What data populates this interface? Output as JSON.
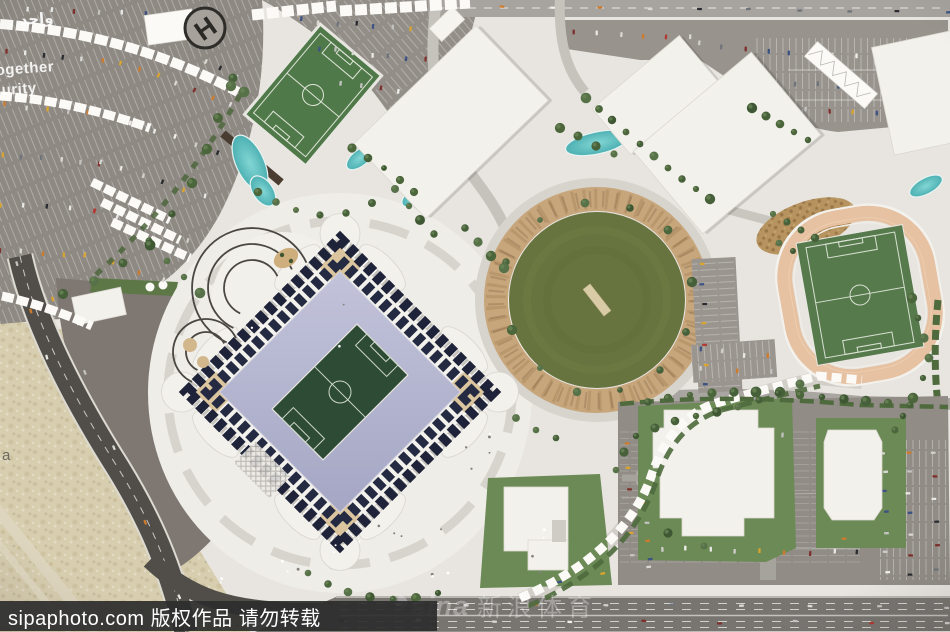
{
  "photo": {
    "subject": "Aerial photograph of an architectural scale model of a stadium sports precinct with training pitch, cricket oval, athletics track, parking fields and desert highway",
    "helipad_letter": "H",
    "ground_text": {
      "arabic_word": "واحد",
      "english_fragment_1": "ogether",
      "english_fragment_2": "urity",
      "sand_letter": "a"
    }
  },
  "watermarks": {
    "sipa_text": "sipaphoto.com 版权作品 请勿转载",
    "sina_brand": "sina",
    "sina_suffix": "新浪体育"
  },
  "palette": {
    "ground": "#e8e5e0",
    "asphalt": "#8e8983",
    "plaza": "#7e7772",
    "sand": "#d7cdaf",
    "road_dark": "#514e49",
    "highway": "#787571",
    "water": "#5fc4c6",
    "training_pitch_green": "#50794a",
    "stadium_pitch_green": "#2e4c35",
    "cricket_green": "#68743f",
    "track_tan": "#e6c1a2",
    "solar_panel_navy": "#1e2339",
    "bowl_lavender": "#b6b7d2",
    "tree_green": "#4c663c",
    "building_white": "#f3f1eb",
    "canopy_white": "#fbfaf7",
    "watermark_bar": "#2d2d2d"
  }
}
